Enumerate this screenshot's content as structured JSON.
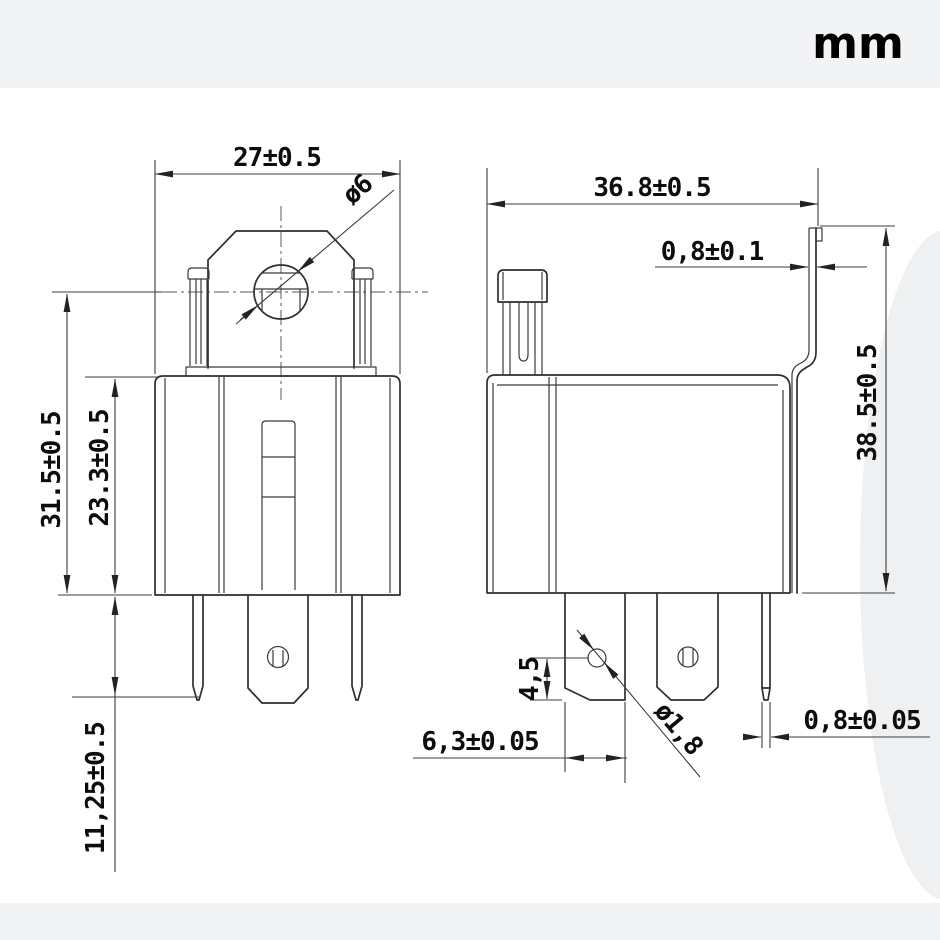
{
  "units_label": "mm",
  "colors": {
    "line": "#2f2f2f",
    "dimension_line": "#3c3c3c",
    "text": "#0d0d0d",
    "band": "#f2f3f5",
    "paper": "#ffffff",
    "shadow_blob": "#eef0f2"
  },
  "views": {
    "front": {
      "dim_width": "27±0.5",
      "dim_hole_diameter": "ø6",
      "dim_overall_height": "31.5±0.5",
      "dim_body_height": "23.3±0.5",
      "dim_pin_length": "11,25±0.5"
    },
    "side": {
      "dim_width": "36.8±0.5",
      "dim_bracket_thickness": "0,8±0.1",
      "dim_overall_height": "38.5±0.5",
      "dim_hole_to_tip": "4,5",
      "dim_blade_width": "6,3±0.05",
      "dim_pin_hole_diameter": "ø1,8",
      "dim_pin_thickness": "0,8±0.05"
    }
  }
}
